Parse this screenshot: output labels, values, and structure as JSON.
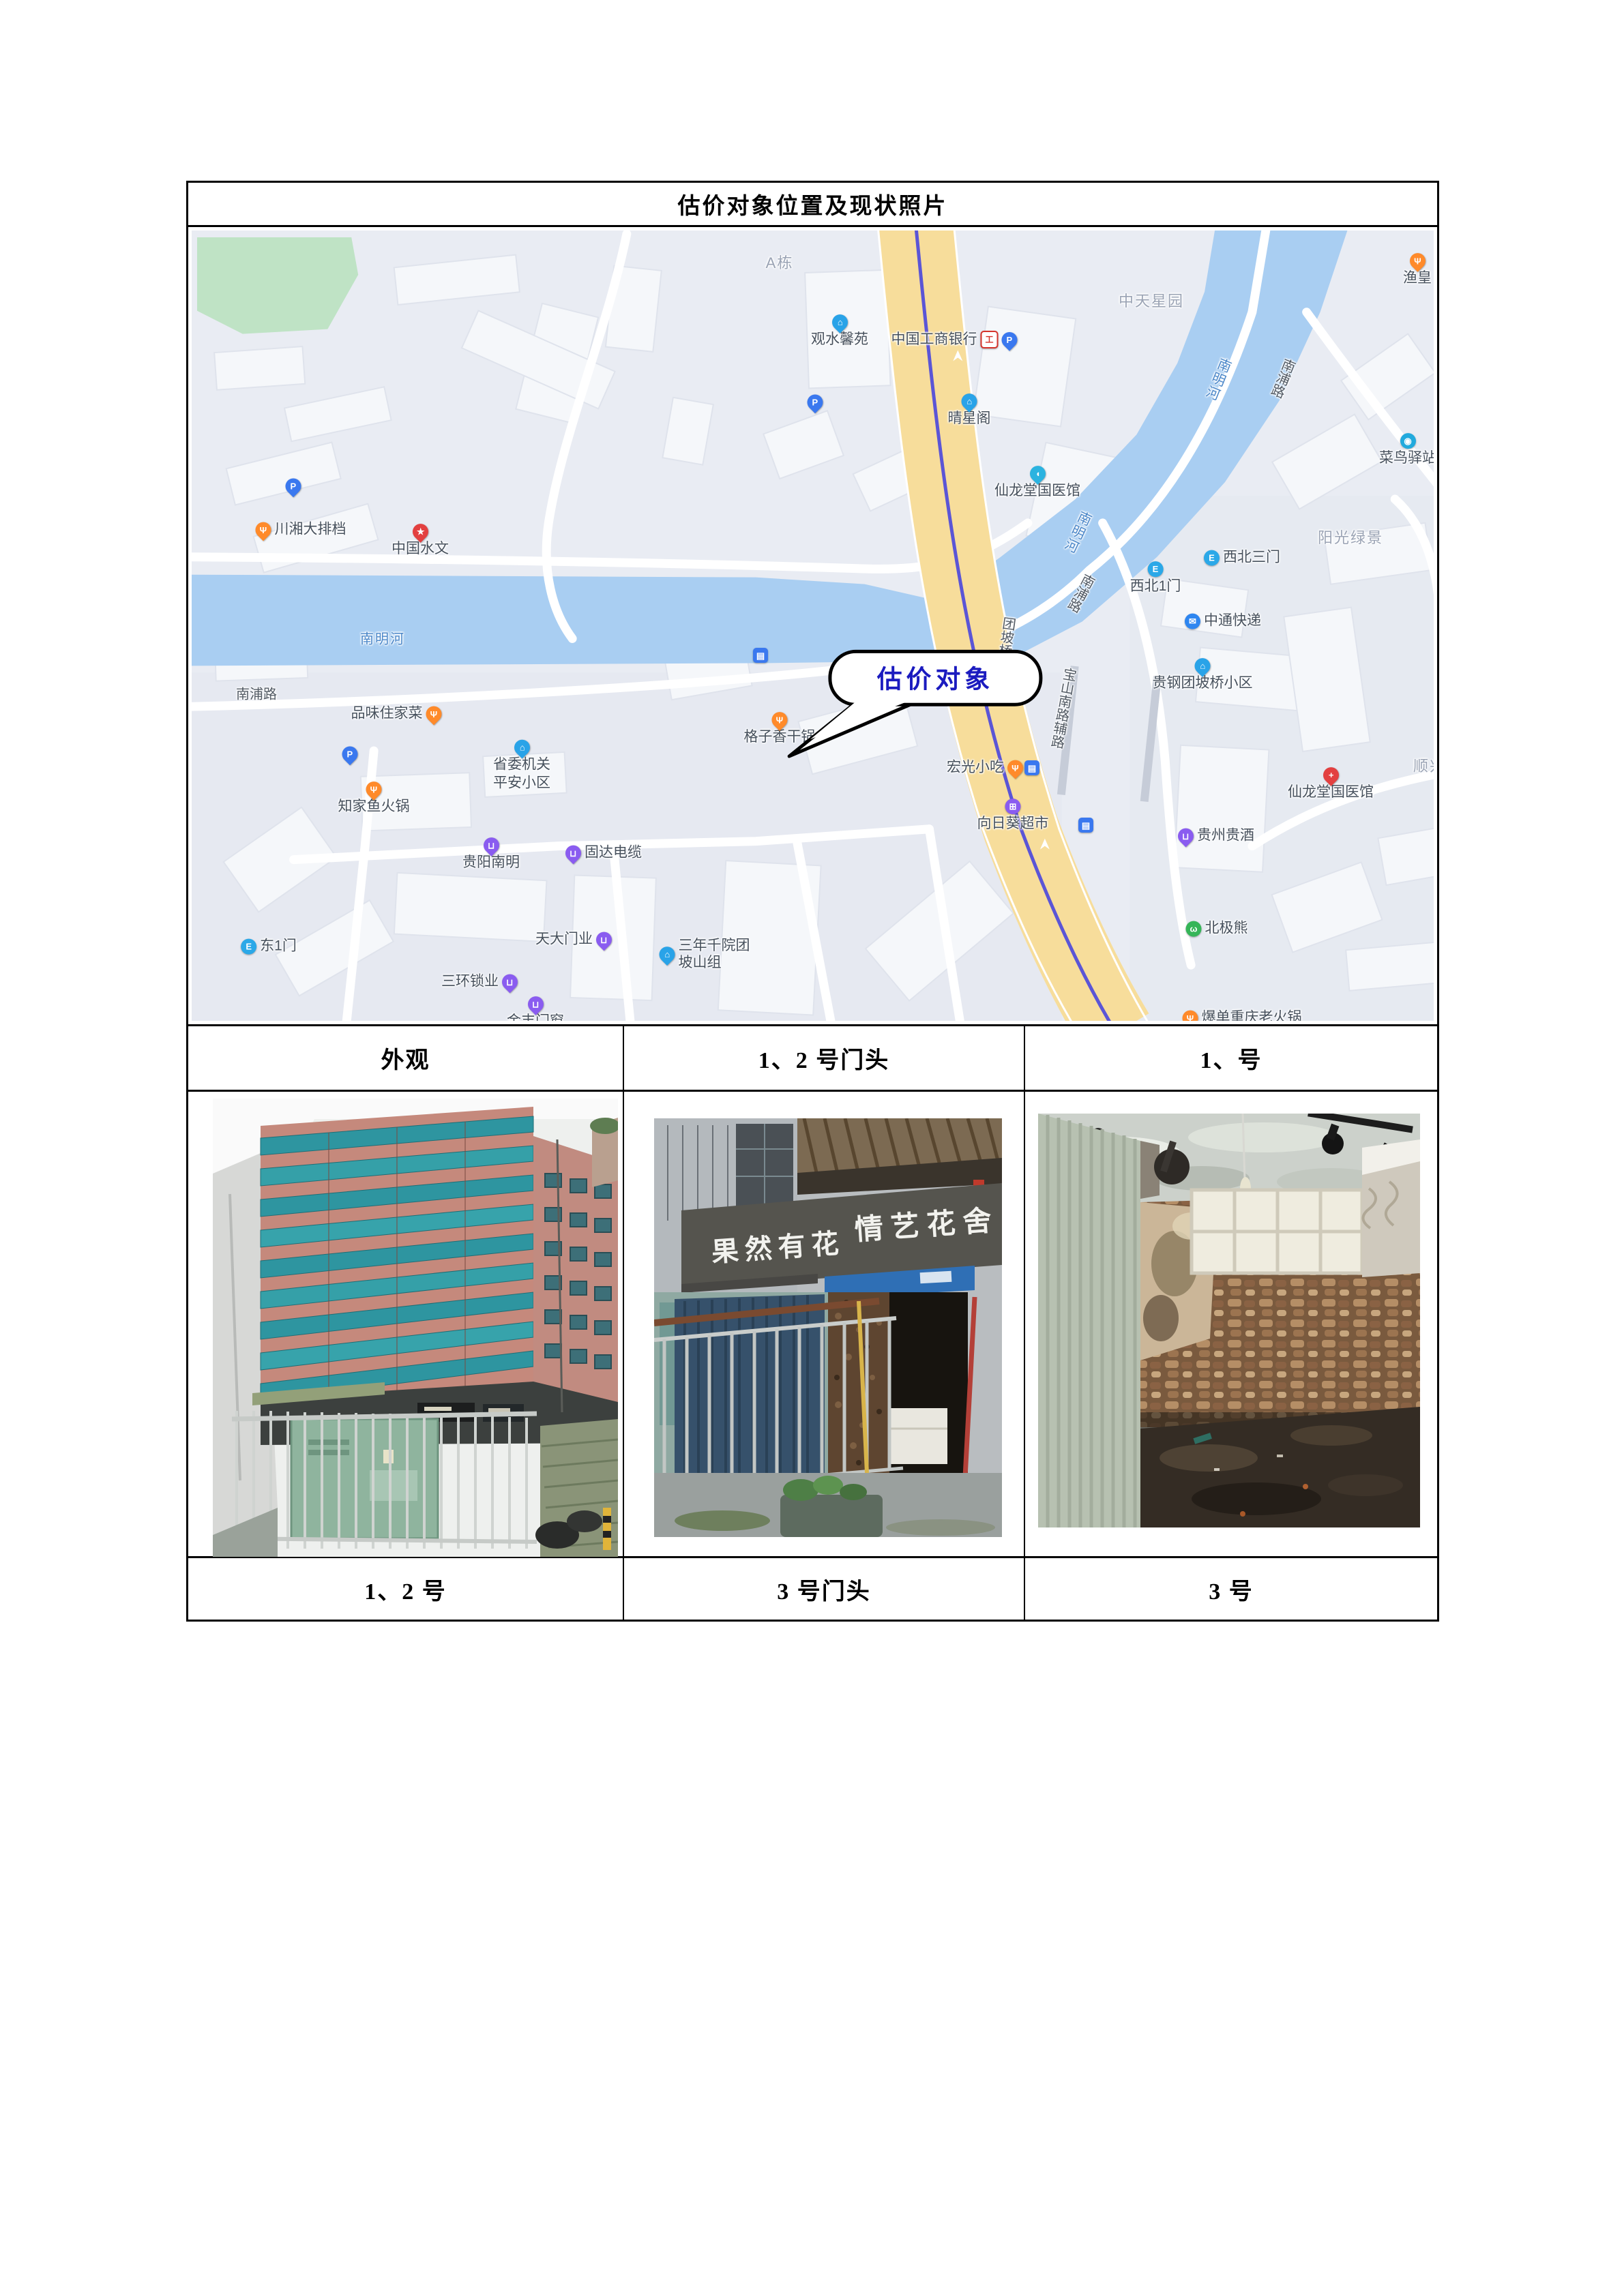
{
  "title": "估价对象位置及现状照片",
  "table": {
    "headers": [
      "外观",
      "1、2 号门头",
      "1、号"
    ],
    "captions": [
      "1、2 号",
      "3 号门头",
      "3 号"
    ]
  },
  "map": {
    "callout": "估价对象",
    "icons": {
      "parking": "P",
      "food": "Ψ",
      "community": "⌂",
      "bank": "工",
      "bus": "▤",
      "gate": "E",
      "shopping": "⊔",
      "courier": "✉",
      "hospital": "+",
      "star": "★",
      "bear": "ω",
      "cart": "⊞",
      "bird": "◉",
      "pill": "◖"
    },
    "road_labels": [
      "南浦路",
      "南浦路",
      "南浦路",
      "南明河",
      "南明河",
      "南明河",
      "团坡桥",
      "宝山南路辅路"
    ],
    "area_labels": [
      "A栋",
      "中天星园",
      "阳光绿景",
      "顺兴"
    ],
    "pois": [
      {
        "label": "川湘大排档"
      },
      {
        "label": "中国水文"
      },
      {
        "label": "品味住家菜"
      },
      {
        "label": "知家鱼火锅"
      },
      {
        "label": "省委机关",
        "label2": "平安小区"
      },
      {
        "label": "贵阳南明"
      },
      {
        "label": "固达电缆"
      },
      {
        "label": "东1门"
      },
      {
        "label": "天大门业"
      },
      {
        "label": "三环锁业"
      },
      {
        "label": "金丰门窗"
      },
      {
        "label": "三年千院团",
        "label2": "坡山组"
      },
      {
        "label": "格子香干锅"
      },
      {
        "label": "宏光小吃"
      },
      {
        "label": "向日葵超市"
      },
      {
        "label": "北极熊"
      },
      {
        "label": "爆单重庆老火锅"
      },
      {
        "label": "贵州贵酒"
      },
      {
        "label": "仙龙堂国医馆"
      },
      {
        "label": "贵钢团坡桥小区"
      },
      {
        "label": "中通快递"
      },
      {
        "label": "西北1门"
      },
      {
        "label": "西北三门"
      },
      {
        "label": "菜鸟驿站"
      },
      {
        "label": "渔皇"
      },
      {
        "label": "晴星阁"
      },
      {
        "label": "中国工商银行"
      },
      {
        "label": "观水馨苑"
      },
      {
        "label": "仙龙堂国医馆"
      }
    ]
  },
  "photos": {
    "sign_left": "果然有花",
    "sign_right": "情艺花舍"
  },
  "colors": {
    "callout_text": "#1b1bbf",
    "map_bg": "#e9ecf3",
    "river": "#a9cef2",
    "park": "#bfe3c5",
    "main_road": "#f7dd9b",
    "road_center_line": "#5b55d6",
    "poi_orange": "#ff8a2a",
    "poi_blue": "#29a3e8",
    "poi_purple": "#8a5cf0",
    "poi_red": "#e34040",
    "poi_green": "#35b558"
  }
}
